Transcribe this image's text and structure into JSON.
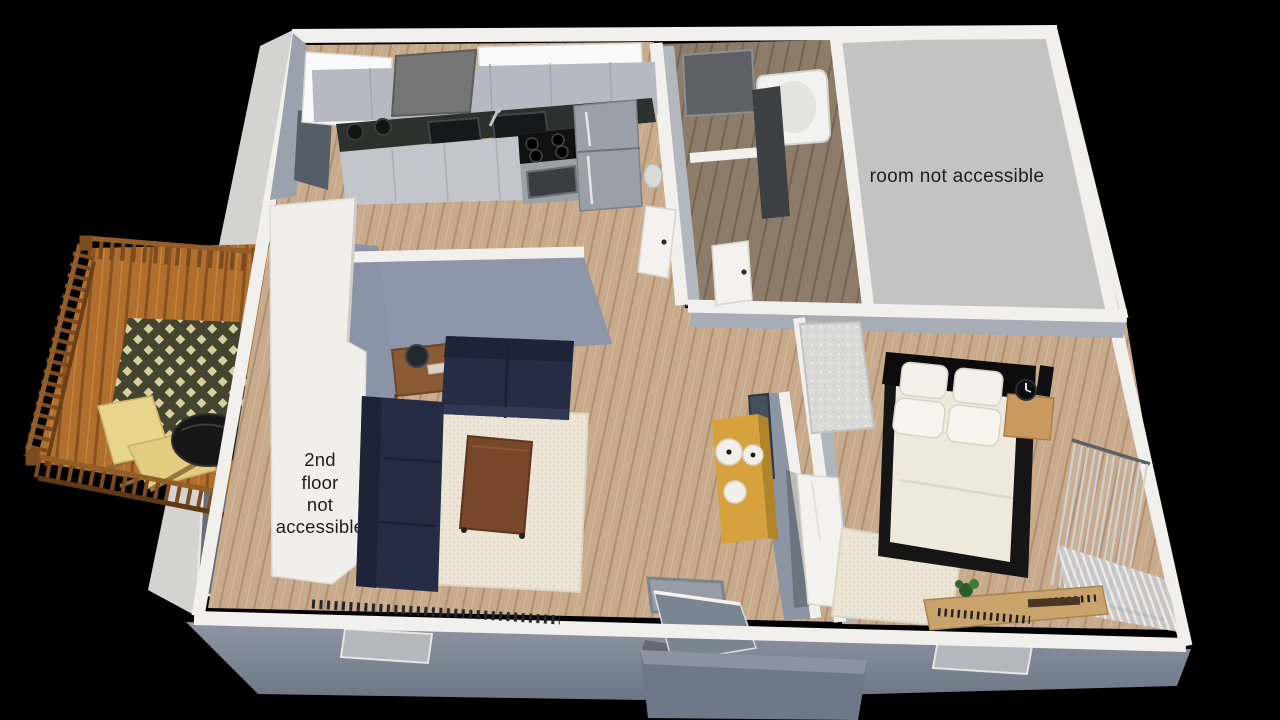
{
  "scene": {
    "description": "3D rendered apartment floor plan, bird's-eye view on black background",
    "rooms": [
      "deck",
      "kitchen",
      "bathroom",
      "inaccessible room",
      "living room",
      "hallway",
      "bedroom",
      "entry"
    ]
  },
  "labels": {
    "room_not_accessible": "room not accessible",
    "second_floor_lines": [
      "2nd",
      "floor",
      "not",
      "accessible"
    ]
  },
  "colors": {
    "background": "#000000",
    "label_text": "#1d1d1d",
    "inaccessible_room_fill": "#c3c3c4",
    "wall_trim": "#f2f0ec",
    "exterior_wall": "#7e8797",
    "interior_wall_face": "#8d97a9",
    "wood_floor": "#c8aa8c",
    "bathroom_floor": "#8d7c69",
    "deck_wood": "#b06f2e",
    "deck_railing": "#7c4b1f",
    "deck_rug": "#45452f",
    "sofa": "#262c44",
    "living_rug": "#ece5d6",
    "coffee_table": "#784628",
    "bed_frame": "#151515",
    "mattress": "#efe9dc",
    "pillow": "#f4f1ea",
    "nightstand": "#c89a60",
    "console_table": "#d7a23d",
    "countertop": "#2b312d",
    "cabinet": "#b6b9c1",
    "fridge": "#9aa0a8"
  }
}
